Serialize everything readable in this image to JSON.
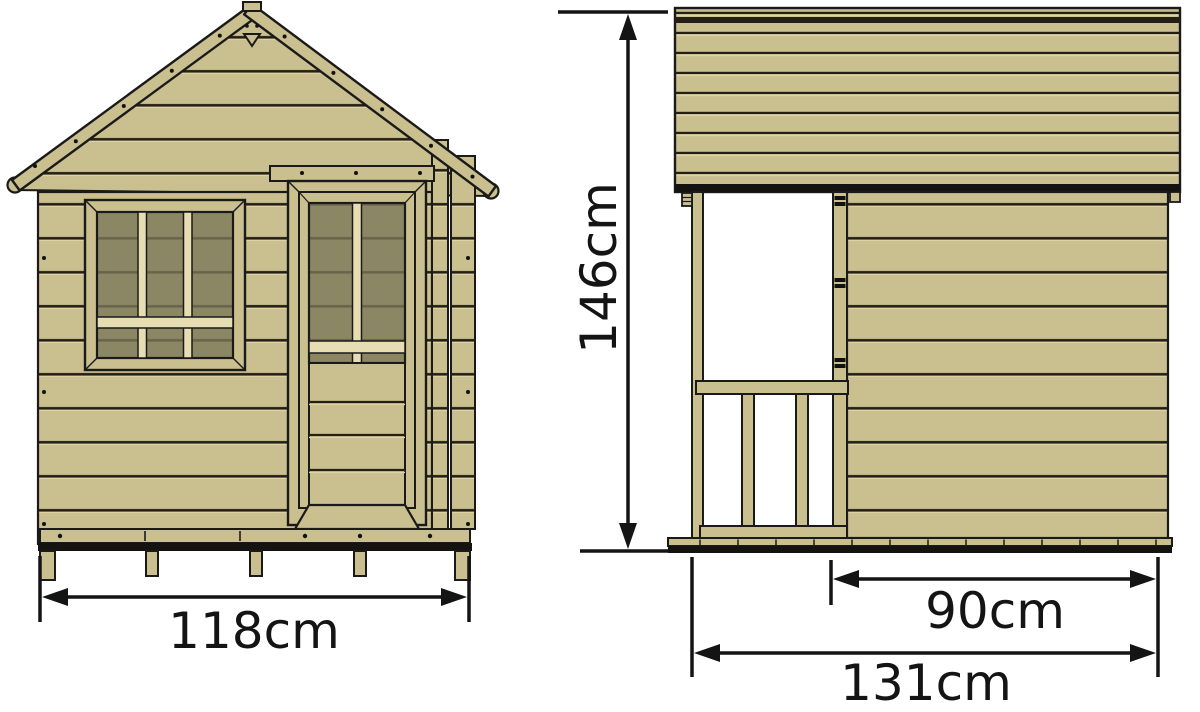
{
  "diagram": {
    "type": "technical-drawing",
    "subject": "wooden playhouse elevations (front view and side view) with overall dimensions",
    "views": {
      "front": "front elevation with window, glazed door and gable roof",
      "side": "side elevation with covered porch, railing and rear cabin wall"
    },
    "dimension_labels": {
      "front_width": "118cm",
      "height": "146cm",
      "cabin_depth": "90cm",
      "total_depth": "131cm"
    },
    "colors": {
      "wood": "#cabf8e",
      "wood_highlight": "#ddd4a6",
      "wood_cream": "#e6ddb2",
      "glass": "#8b8664",
      "glass_shadow": "#6a654a",
      "outline": "#1a1a1a",
      "dimension": "#141414",
      "background": "#ffffff"
    }
  }
}
